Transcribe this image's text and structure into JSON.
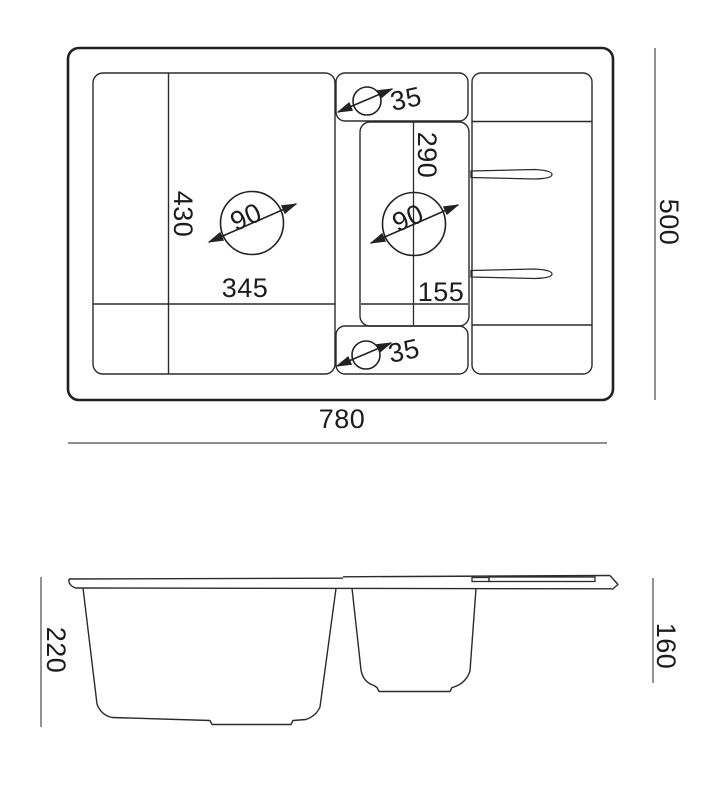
{
  "drawing": {
    "type": "sink-technical-drawing",
    "colors": {
      "line": "#2b2b2b",
      "dim_line": "#4a4a4a",
      "text": "#1c1c1c",
      "background": "#ffffff"
    },
    "top_view": {
      "total_width": "780",
      "total_depth": "500",
      "main_bowl_width": "345",
      "main_bowl_depth": "430",
      "main_drain_diameter": "90",
      "small_bowl_length": "290",
      "small_bowl_width": "155",
      "small_drain_diameter": "90",
      "tap_hole_top_diameter": "35",
      "tap_hole_bottom_diameter": "35"
    },
    "side_view": {
      "main_bowl_depth": "220",
      "small_bowl_depth": "160"
    }
  }
}
